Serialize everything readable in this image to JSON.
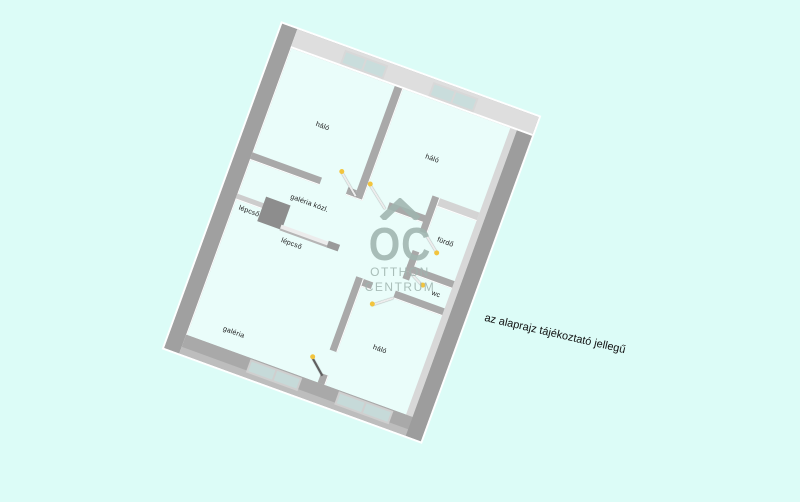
{
  "watermark": {
    "roof_icon": "house-roof-icon",
    "logo_text": "OC",
    "line1": "OTTHON",
    "line2": "CENTRUM"
  },
  "disclaimer": "az alaprajz tájékoztató jellegű",
  "floor_plan": {
    "type": "apartment-floor-plan-3d",
    "rotation_deg": 20,
    "rooms": [
      {
        "name": "bedroom-top-left",
        "label": "háló"
      },
      {
        "name": "bedroom-top-right",
        "label": "háló"
      },
      {
        "name": "gallery-hall",
        "label": "galéria közl."
      },
      {
        "name": "stairs-upper",
        "label": "lépcső"
      },
      {
        "name": "stairs-lower",
        "label": "lépcső"
      },
      {
        "name": "bathroom",
        "label": "fürdő"
      },
      {
        "name": "toilet",
        "label": "wc"
      },
      {
        "name": "gallery",
        "label": "galéria"
      },
      {
        "name": "bedroom-bottom",
        "label": "háló"
      }
    ],
    "window_units": 4,
    "door_count": 6
  },
  "colors": {
    "bg": "#dcfcf7",
    "floor": "#eafdfa",
    "wall_light": "#dedede",
    "wall_medium": "#a9a9a9",
    "wall_dark": "#a0a0a0",
    "window_pane": "#c9dddc",
    "hinge": "#f2c43d",
    "watermark": "#9fb5af"
  }
}
